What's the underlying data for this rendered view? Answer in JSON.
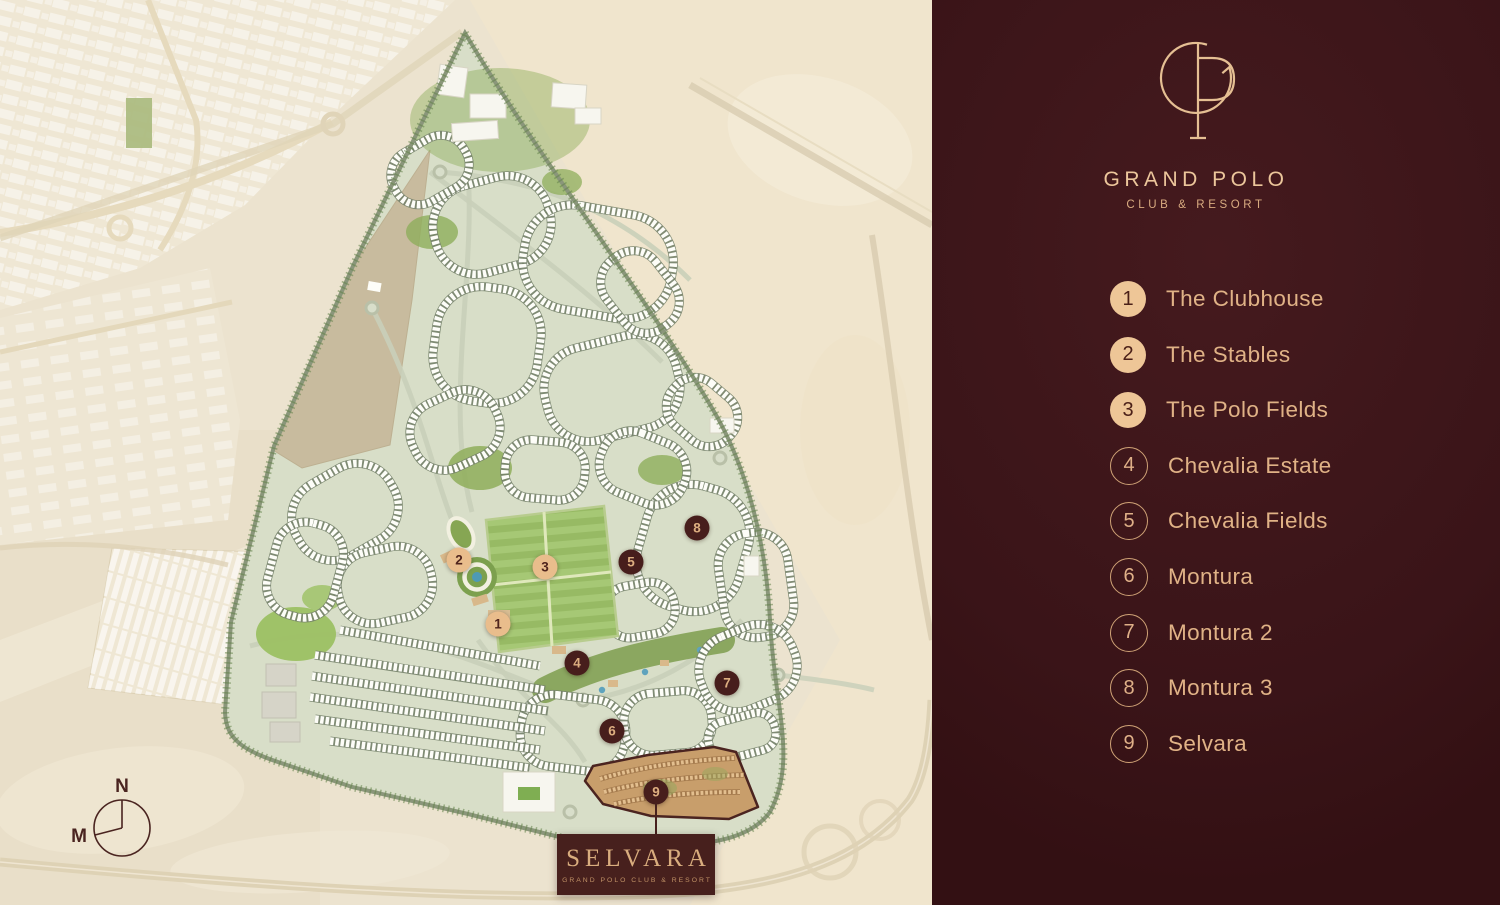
{
  "brand": {
    "title": "GRAND POLO",
    "subtitle": "CLUB & RESORT",
    "monogram": "GP"
  },
  "sidebar": {
    "legend": [
      {
        "number": "1",
        "label": "The Clubhouse",
        "filled": true
      },
      {
        "number": "2",
        "label": "The Stables",
        "filled": true
      },
      {
        "number": "3",
        "label": "The Polo Fields",
        "filled": true
      },
      {
        "number": "4",
        "label": "Chevalia Estate",
        "filled": false
      },
      {
        "number": "5",
        "label": "Chevalia Fields",
        "filled": false
      },
      {
        "number": "6",
        "label": "Montura",
        "filled": false
      },
      {
        "number": "7",
        "label": "Montura 2",
        "filled": false
      },
      {
        "number": "8",
        "label": "Montura 3",
        "filled": false
      },
      {
        "number": "9",
        "label": "Selvara",
        "filled": false
      }
    ]
  },
  "map": {
    "markers": [
      {
        "number": "1",
        "label": "The Clubhouse",
        "style": "filled",
        "x": 498,
        "y": 624
      },
      {
        "number": "2",
        "label": "The Stables",
        "style": "filled",
        "x": 459,
        "y": 560
      },
      {
        "number": "3",
        "label": "The Polo Fields",
        "style": "filled",
        "x": 545,
        "y": 567
      },
      {
        "number": "4",
        "label": "Chevalia Estate",
        "style": "dark",
        "x": 577,
        "y": 663
      },
      {
        "number": "5",
        "label": "Chevalia Fields",
        "style": "dark",
        "x": 631,
        "y": 562
      },
      {
        "number": "6",
        "label": "Montura",
        "style": "dark",
        "x": 612,
        "y": 731
      },
      {
        "number": "7",
        "label": "Montura 2",
        "style": "dark",
        "x": 727,
        "y": 683
      },
      {
        "number": "8",
        "label": "Montura 3",
        "style": "dark",
        "x": 697,
        "y": 528
      },
      {
        "number": "9",
        "label": "Selvara",
        "style": "dark",
        "x": 656,
        "y": 792
      }
    ],
    "selvara_callout": {
      "title": "SELVARA",
      "subtitle": "GRAND POLO CLUB & RESORT"
    },
    "compass": {
      "north_label": "N",
      "west_label": "M"
    }
  },
  "colors": {
    "sidebar_bg": "#3a1418",
    "accent_tan": "#e0b286",
    "legend_filled_circle": "#eec697",
    "marker_dark": "#471e1c",
    "marker_filled": "#e9bd8c",
    "desert": "#ece3cf",
    "site_green": "#d8dec8",
    "polo_field_green": "#9cbd68",
    "selvara_district_tan": "#c89e6b",
    "selvara_outline": "#4b2420"
  }
}
